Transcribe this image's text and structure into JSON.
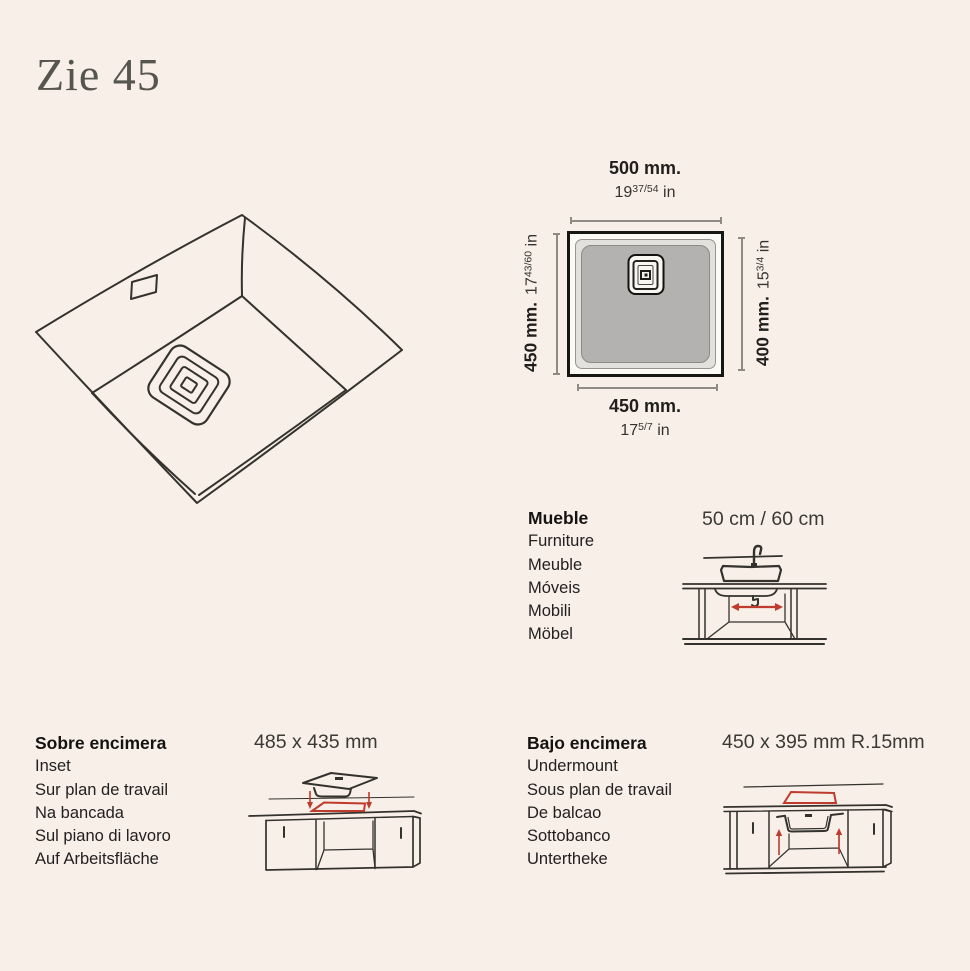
{
  "title": "Zie 45",
  "plan": {
    "top": {
      "mm": "500 mm.",
      "whole": "19",
      "frac": "37/54",
      "unit": "in"
    },
    "left": {
      "mm": "450 mm.",
      "whole": "17",
      "frac": "43/60",
      "unit": "in"
    },
    "right": {
      "mm": "400 mm.",
      "whole": "15",
      "frac": "3/4",
      "unit": "in"
    },
    "bottom": {
      "mm": "450 mm.",
      "whole": "17",
      "frac": "5/7",
      "unit": "in"
    }
  },
  "cabinet_section": {
    "title": "Mueble",
    "labels": [
      "Furniture",
      "Meuble",
      "Móveis",
      "Mobili",
      "Möbel"
    ],
    "size": "50 cm / 60 cm"
  },
  "inset_section": {
    "title": "Sobre encimera",
    "labels": [
      "Inset",
      "Sur plan de travail",
      "Na bancada",
      "Sul piano di lavoro",
      "Auf Arbeitsfläche"
    ],
    "size": "485 x 435 mm"
  },
  "undermount_section": {
    "title": "Bajo encimera",
    "labels": [
      "Undermount",
      "Sous plan de travail",
      "De balcao",
      "Sottobanco",
      "Untertheke"
    ],
    "size": "450 x 395 mm R.15mm"
  },
  "colors": {
    "background": "#f8efe9",
    "sketch_line": "#34322c",
    "accent_red": "#bf3b2d",
    "bowl_gray": "#b3b2b0",
    "title_gray": "#56554e"
  }
}
